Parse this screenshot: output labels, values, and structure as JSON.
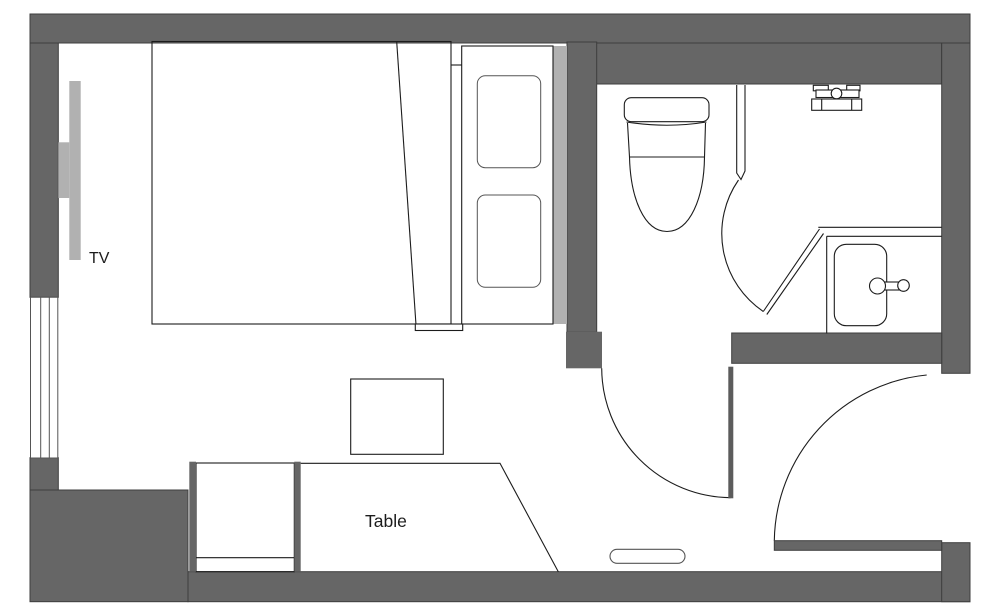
{
  "labels": {
    "tv": "TV",
    "table": "Table"
  },
  "colors": {
    "background": "#ffffff",
    "wall": "#666666",
    "wall_stroke": "#3d3d3d",
    "door_leaf": "#5c5c5c",
    "fixture_light": "#b1b1b1",
    "ink": "#1c1c1c",
    "ink_soft": "#555555"
  },
  "fixtures": [
    "bed",
    "pillow",
    "headboard",
    "tv",
    "window",
    "stool",
    "desk-cabinet",
    "table",
    "toilet",
    "shower-mixer",
    "vanity-counter",
    "washbasin",
    "basin-faucet",
    "bathroom-door",
    "hall-door",
    "entrance-door",
    "entry-step"
  ]
}
